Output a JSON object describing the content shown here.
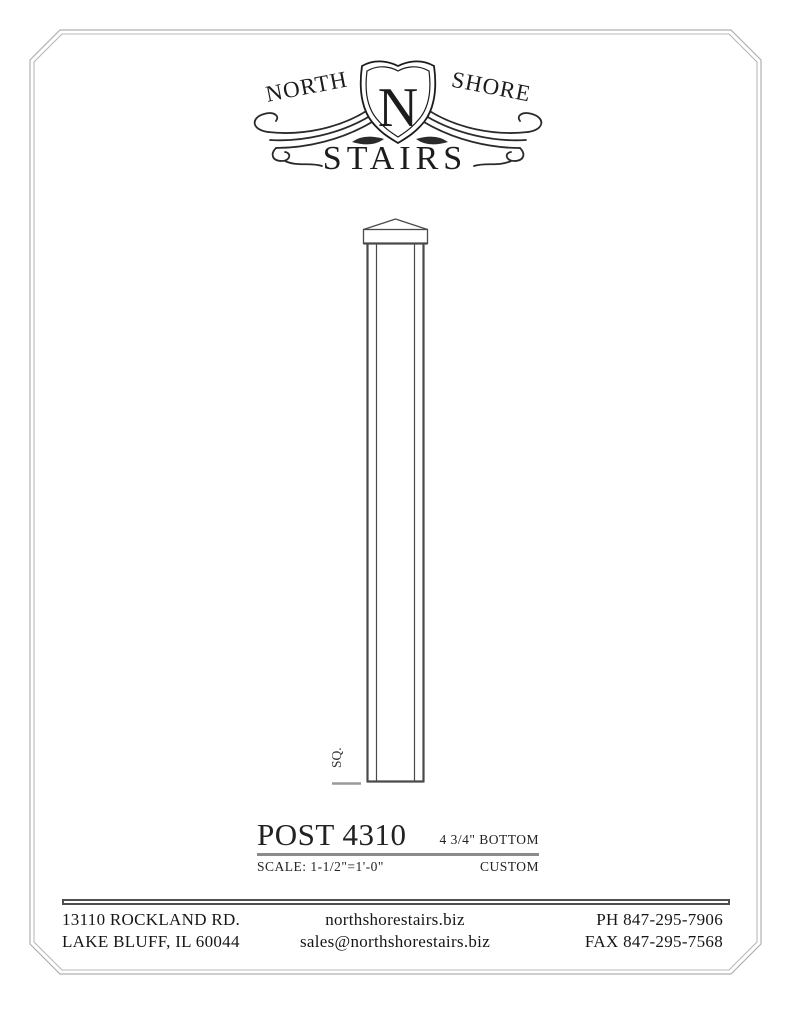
{
  "colors": {
    "sheet_border": "#b0b0b0",
    "rule_gray": "#8a8a8a",
    "drawing_line": "#4a4a4a",
    "text_dark": "#1c1c1c"
  },
  "logo": {
    "north": "NORTH",
    "shield_letter": "N",
    "shore": "SHORE",
    "stairs": "STAIRS"
  },
  "drawing": {
    "square_label": "SQ."
  },
  "title_block": {
    "title": "POST 4310",
    "dimension_label": "4 3/4\" BOTTOM",
    "scale_label": "SCALE: 1-1/2\"=1'-0\"",
    "type_label": "CUSTOM"
  },
  "footer": {
    "address_line1": "13110 ROCKLAND RD.",
    "address_line2": "LAKE BLUFF, IL 60044",
    "website": "northshorestairs.biz",
    "email": "sales@northshorestairs.biz",
    "phone": "PH 847-295-7906",
    "fax": "FAX 847-295-7568"
  }
}
